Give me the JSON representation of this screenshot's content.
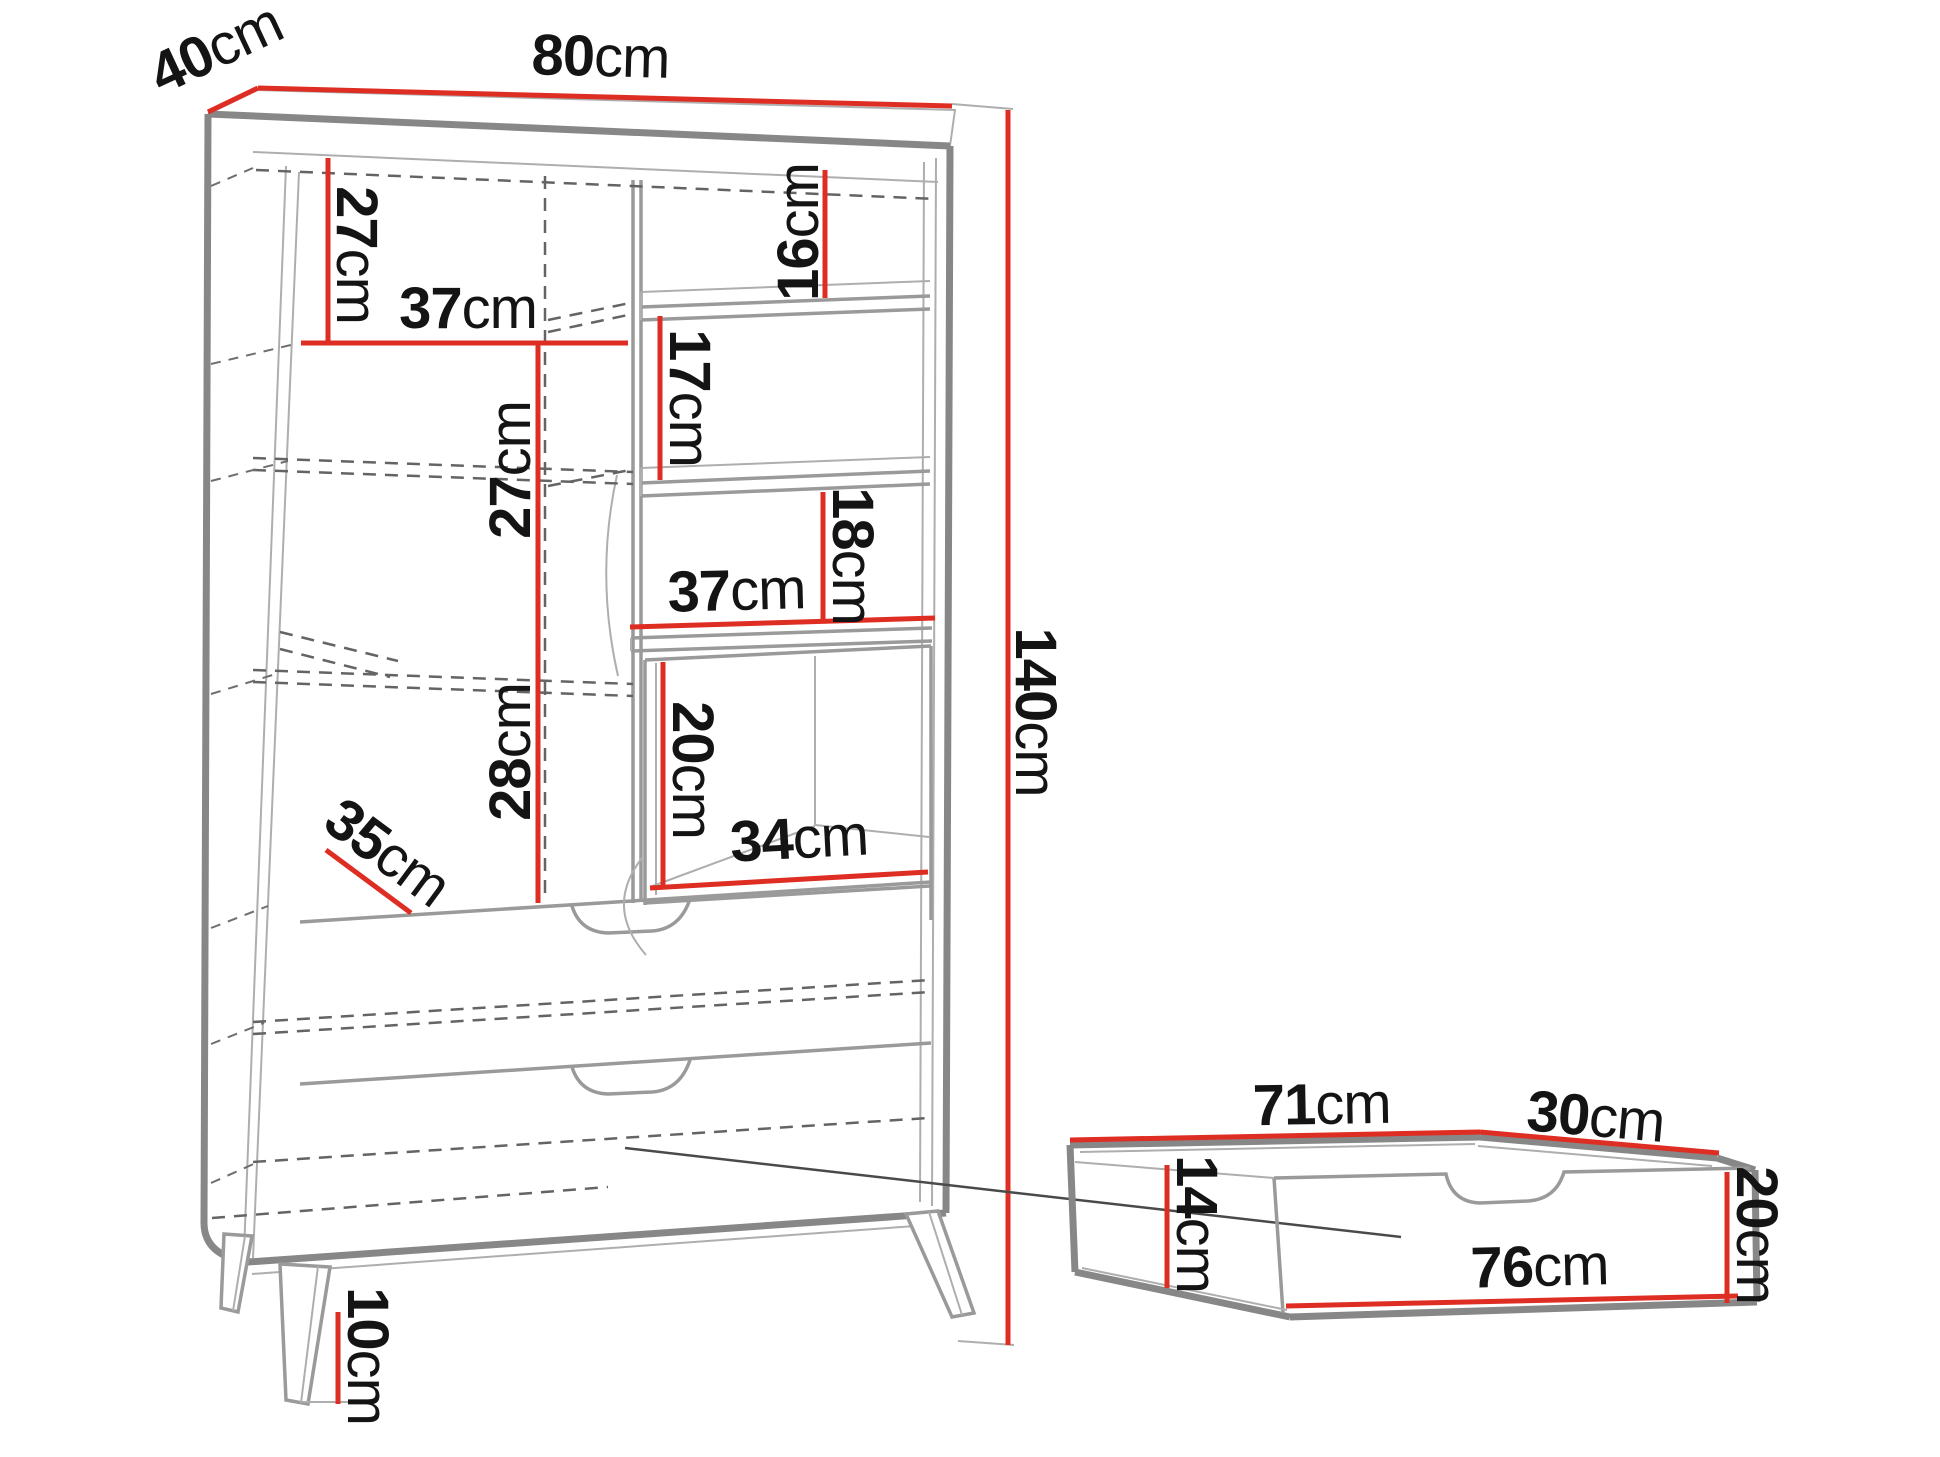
{
  "colors": {
    "dimension_red": "#de2d23",
    "structure_gray": "#878787",
    "text_color": "#141414",
    "background": "#ffffff"
  },
  "cabinet": {
    "width_top": {
      "num": "80",
      "unit": "cm"
    },
    "depth_top": {
      "num": "40",
      "unit": "cm"
    },
    "height_total": {
      "num": "140",
      "unit": "cm"
    },
    "h27_top_left": {
      "num": "27",
      "unit": "cm"
    },
    "w37_top": {
      "num": "37",
      "unit": "cm"
    },
    "h16": {
      "num": "16",
      "unit": "cm"
    },
    "h17": {
      "num": "17",
      "unit": "cm"
    },
    "h27_mid": {
      "num": "27",
      "unit": "cm"
    },
    "h18": {
      "num": "18",
      "unit": "cm"
    },
    "w37_mid": {
      "num": "37",
      "unit": "cm"
    },
    "h28": {
      "num": "28",
      "unit": "cm"
    },
    "h20_cube": {
      "num": "20",
      "unit": "cm"
    },
    "w34_cube": {
      "num": "34",
      "unit": "cm"
    },
    "d35_diagonal": {
      "num": "35",
      "unit": "cm"
    },
    "h10_legs": {
      "num": "10",
      "unit": "cm"
    }
  },
  "drawer": {
    "w71_top": {
      "num": "71",
      "unit": "cm"
    },
    "d30_top": {
      "num": "30",
      "unit": "cm"
    },
    "h14_inner": {
      "num": "14",
      "unit": "cm"
    },
    "h20_front": {
      "num": "20",
      "unit": "cm"
    },
    "w76_front": {
      "num": "76",
      "unit": "cm"
    }
  }
}
